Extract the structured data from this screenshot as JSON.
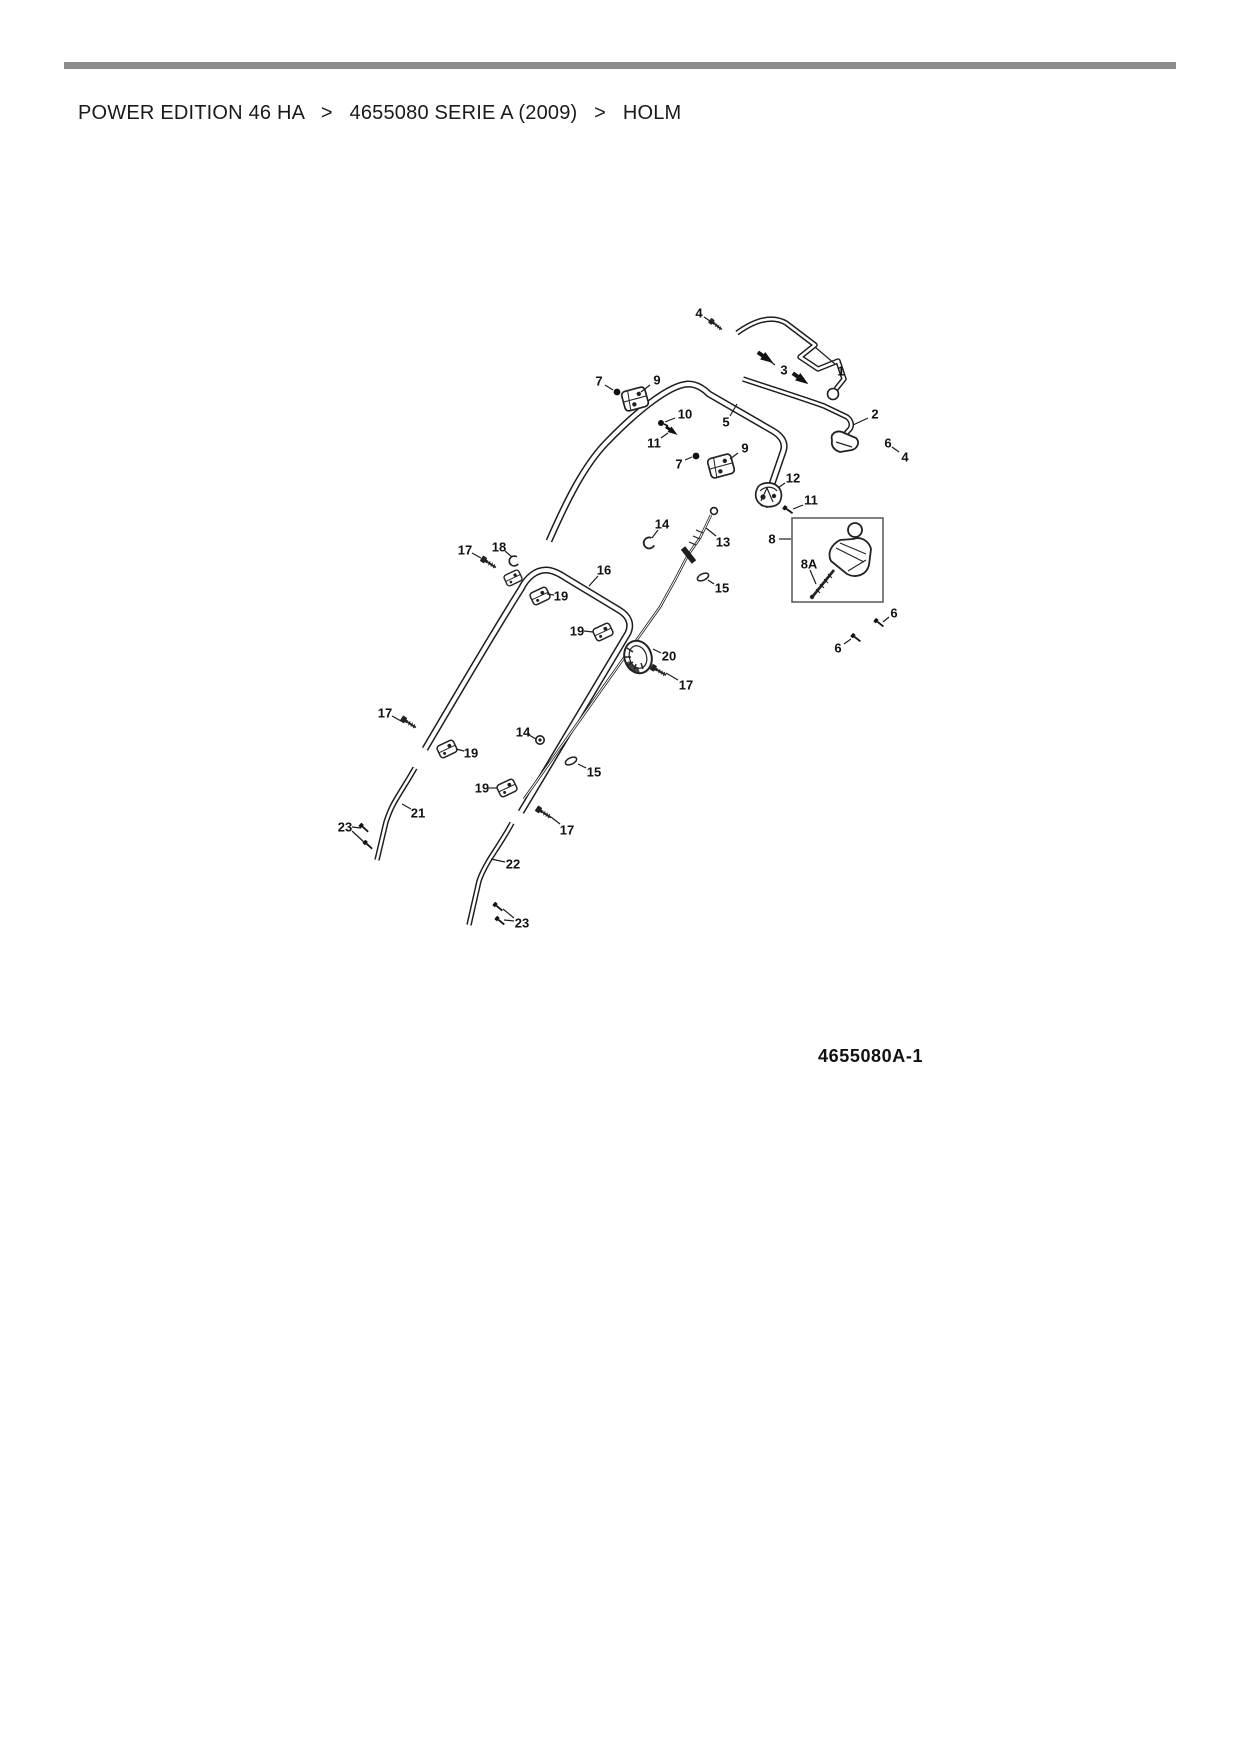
{
  "breadcrumb": {
    "separator": ">",
    "items": [
      {
        "label": "POWER EDITION 46 HA"
      },
      {
        "label": "4655080 SERIE A (2009)"
      },
      {
        "label": "HOLM"
      }
    ]
  },
  "colors": {
    "rule_gray": "#8c8c8c",
    "ink": "#1a1a1a"
  },
  "diagram": {
    "figure_id": "4655080A-1",
    "figure_id_pos": {
      "x": 818,
      "y": 1062
    },
    "callouts": [
      {
        "label": "4",
        "x": 699,
        "y": 313,
        "leaders": [
          [
            704,
            317,
            713,
            323
          ]
        ]
      },
      {
        "label": "3",
        "x": 784,
        "y": 370,
        "leaders": [
          [
            775,
            365,
            767,
            359
          ],
          [
            793,
            373,
            800,
            378
          ]
        ]
      },
      {
        "label": "1",
        "x": 841,
        "y": 371,
        "leaders": [
          [
            835,
            364,
            815,
            347
          ]
        ]
      },
      {
        "label": "2",
        "x": 875,
        "y": 414,
        "leaders": [
          [
            868,
            418,
            853,
            425
          ]
        ]
      },
      {
        "label": "6",
        "x": 888,
        "y": 443,
        "leaders": [
          [
            892,
            447,
            899,
            452
          ]
        ]
      },
      {
        "label": "4",
        "x": 905,
        "y": 457,
        "leaders": []
      },
      {
        "label": "7",
        "x": 599,
        "y": 381,
        "leaders": [
          [
            605,
            385,
            613,
            390
          ]
        ]
      },
      {
        "label": "9",
        "x": 657,
        "y": 380,
        "leaders": [
          [
            650,
            385,
            641,
            392
          ]
        ]
      },
      {
        "label": "10",
        "x": 685,
        "y": 414,
        "leaders": [
          [
            675,
            418,
            665,
            422
          ]
        ]
      },
      {
        "label": "11",
        "x": 654,
        "y": 443,
        "leaders": [
          [
            661,
            438,
            668,
            433
          ]
        ]
      },
      {
        "label": "5",
        "x": 726,
        "y": 422,
        "leaders": [
          [
            730,
            416,
            737,
            404
          ]
        ]
      },
      {
        "label": "7",
        "x": 679,
        "y": 464,
        "leaders": [
          [
            685,
            460,
            692,
            457
          ]
        ]
      },
      {
        "label": "9",
        "x": 745,
        "y": 448,
        "leaders": [
          [
            738,
            453,
            730,
            459
          ]
        ]
      },
      {
        "label": "12",
        "x": 793,
        "y": 478,
        "leaders": [
          [
            785,
            483,
            778,
            488
          ]
        ]
      },
      {
        "label": "11",
        "x": 811,
        "y": 500,
        "leaders": [
          [
            803,
            505,
            793,
            509
          ]
        ]
      },
      {
        "label": "8",
        "x": 772,
        "y": 539,
        "leaders": [
          [
            779,
            539,
            791,
            539
          ]
        ]
      },
      {
        "label": "8A",
        "x": 809,
        "y": 564,
        "leaders": [
          [
            810,
            570,
            816,
            584
          ]
        ]
      },
      {
        "label": "14",
        "x": 662,
        "y": 524,
        "leaders": [
          [
            658,
            530,
            652,
            538
          ]
        ]
      },
      {
        "label": "13",
        "x": 723,
        "y": 542,
        "leaders": [
          [
            716,
            536,
            706,
            528
          ]
        ]
      },
      {
        "label": "15",
        "x": 722,
        "y": 588,
        "leaders": [
          [
            714,
            584,
            708,
            580
          ]
        ]
      },
      {
        "label": "17",
        "x": 465,
        "y": 550,
        "leaders": [
          [
            472,
            553,
            481,
            558
          ]
        ]
      },
      {
        "label": "18",
        "x": 499,
        "y": 547,
        "leaders": [
          [
            505,
            551,
            512,
            557
          ]
        ]
      },
      {
        "label": "16",
        "x": 604,
        "y": 570,
        "leaders": [
          [
            598,
            576,
            589,
            586
          ]
        ]
      },
      {
        "label": "19",
        "x": 561,
        "y": 596,
        "leaders": [
          [
            554,
            595,
            547,
            594
          ]
        ]
      },
      {
        "label": "19",
        "x": 577,
        "y": 631,
        "leaders": [
          [
            584,
            631,
            593,
            632
          ]
        ]
      },
      {
        "label": "20",
        "x": 669,
        "y": 656,
        "leaders": [
          [
            661,
            653,
            653,
            649
          ]
        ]
      },
      {
        "label": "17",
        "x": 686,
        "y": 685,
        "leaders": [
          [
            678,
            680,
            666,
            673
          ]
        ]
      },
      {
        "label": "6",
        "x": 894,
        "y": 613,
        "leaders": [
          [
            889,
            617,
            883,
            622
          ]
        ]
      },
      {
        "label": "6",
        "x": 838,
        "y": 648,
        "leaders": [
          [
            844,
            644,
            851,
            639
          ]
        ]
      },
      {
        "label": "17",
        "x": 385,
        "y": 713,
        "leaders": [
          [
            392,
            716,
            401,
            721
          ]
        ]
      },
      {
        "label": "14",
        "x": 523,
        "y": 732,
        "leaders": [
          [
            529,
            735,
            536,
            739
          ]
        ]
      },
      {
        "label": "19",
        "x": 471,
        "y": 753,
        "leaders": [
          [
            464,
            751,
            456,
            749
          ]
        ]
      },
      {
        "label": "15",
        "x": 594,
        "y": 772,
        "leaders": [
          [
            586,
            768,
            578,
            764
          ]
        ]
      },
      {
        "label": "19",
        "x": 482,
        "y": 788,
        "leaders": [
          [
            489,
            788,
            497,
            788
          ]
        ]
      },
      {
        "label": "17",
        "x": 567,
        "y": 830,
        "leaders": [
          [
            560,
            824,
            551,
            817
          ]
        ]
      },
      {
        "label": "21",
        "x": 418,
        "y": 813,
        "leaders": [
          [
            411,
            809,
            402,
            804
          ]
        ]
      },
      {
        "label": "23",
        "x": 345,
        "y": 827,
        "leaders": [
          [
            352,
            827,
            361,
            828
          ],
          [
            352,
            831,
            365,
            843
          ]
        ]
      },
      {
        "label": "22",
        "x": 513,
        "y": 864,
        "leaders": [
          [
            505,
            862,
            491,
            859
          ]
        ]
      },
      {
        "label": "23",
        "x": 522,
        "y": 923,
        "leaders": [
          [
            514,
            918,
            503,
            909
          ],
          [
            514,
            921,
            504,
            920
          ]
        ]
      }
    ],
    "parts": [
      {
        "glyph": "screw",
        "x": 716,
        "y": 325,
        "r": 38,
        "s": 0.8
      },
      {
        "glyph": "pin",
        "x": 766,
        "y": 358,
        "r": 35,
        "s": 1
      },
      {
        "glyph": "pin",
        "x": 801,
        "y": 379,
        "r": 35,
        "s": 1
      },
      {
        "glyph": "dot",
        "x": 617,
        "y": 392,
        "r": 0,
        "s": 1
      },
      {
        "glyph": "clamp9",
        "x": 635,
        "y": 399,
        "r": -15,
        "s": 1
      },
      {
        "glyph": "boltdot",
        "x": 661,
        "y": 423,
        "r": 0,
        "s": 1
      },
      {
        "glyph": "pin",
        "x": 672,
        "y": 431,
        "r": 35,
        "s": 0.75
      },
      {
        "glyph": "dot",
        "x": 696,
        "y": 456,
        "r": 0,
        "s": 1
      },
      {
        "glyph": "clamp9",
        "x": 721,
        "y": 466,
        "r": -15,
        "s": 1
      },
      {
        "glyph": "part12",
        "x": 769,
        "y": 495,
        "r": 0,
        "s": 1
      },
      {
        "glyph": "screwdark",
        "x": 788,
        "y": 510,
        "r": 35,
        "s": 0.7
      },
      {
        "glyph": "clip",
        "x": 649,
        "y": 543,
        "r": -20,
        "s": 1
      },
      {
        "glyph": "oval",
        "x": 703,
        "y": 577,
        "r": -25,
        "s": 1
      },
      {
        "glyph": "screw",
        "x": 489,
        "y": 563,
        "r": 33,
        "s": 0.9
      },
      {
        "glyph": "clip",
        "x": 514,
        "y": 561,
        "r": -10,
        "s": 0.9
      },
      {
        "glyph": "clamp19",
        "x": 513,
        "y": 578,
        "r": -25,
        "s": 0.9
      },
      {
        "glyph": "clamp19",
        "x": 540,
        "y": 596,
        "r": -25,
        "s": 1
      },
      {
        "glyph": "clamp19",
        "x": 603,
        "y": 632,
        "r": -25,
        "s": 1
      },
      {
        "glyph": "part20",
        "x": 638,
        "y": 657,
        "r": 0,
        "s": 1
      },
      {
        "glyph": "screw",
        "x": 659,
        "y": 671,
        "r": 30,
        "s": 0.9
      },
      {
        "glyph": "screwdark",
        "x": 879,
        "y": 623,
        "r": 38,
        "s": 0.7
      },
      {
        "glyph": "screwdark",
        "x": 856,
        "y": 638,
        "r": 38,
        "s": 0.7
      },
      {
        "glyph": "screw",
        "x": 409,
        "y": 723,
        "r": 33,
        "s": 0.9
      },
      {
        "glyph": "clamp19",
        "x": 447,
        "y": 749,
        "r": -25,
        "s": 1
      },
      {
        "glyph": "nut",
        "x": 540,
        "y": 740,
        "r": 0,
        "s": 1
      },
      {
        "glyph": "oval",
        "x": 571,
        "y": 761,
        "r": -25,
        "s": 1
      },
      {
        "glyph": "clamp19",
        "x": 507,
        "y": 788,
        "r": -25,
        "s": 1
      },
      {
        "glyph": "screw",
        "x": 544,
        "y": 813,
        "r": 33,
        "s": 0.9
      },
      {
        "glyph": "screwdark",
        "x": 364,
        "y": 828,
        "r": 42,
        "s": 0.7
      },
      {
        "glyph": "screwdark",
        "x": 368,
        "y": 845,
        "r": 42,
        "s": 0.7
      },
      {
        "glyph": "screwdark",
        "x": 498,
        "y": 907,
        "r": 40,
        "s": 0.7
      },
      {
        "glyph": "screwdark",
        "x": 500,
        "y": 921,
        "r": 40,
        "s": 0.7
      }
    ]
  }
}
